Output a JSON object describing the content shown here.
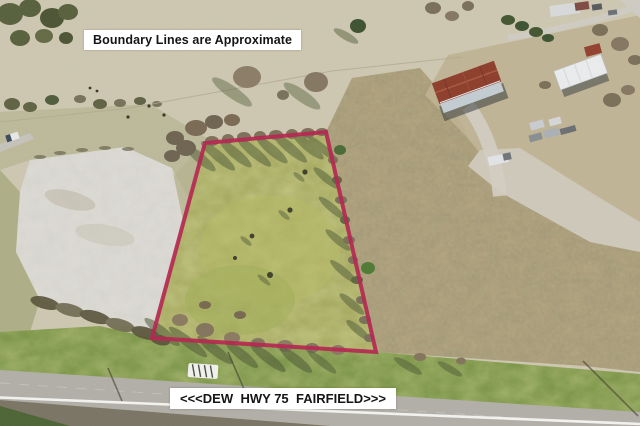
{
  "overlay": {
    "boundary_note": "Boundary Lines are Approximate",
    "road_left": "<<<DEW",
    "road_center": "HWY 75",
    "road_right": "FAIRFIELD>>>"
  },
  "colors": {
    "boundary": "#b5244f",
    "label_bg": "#ffffff",
    "label_text": "#151515",
    "parcel_green": "#a8ab61",
    "road_gray": "#b2afa8",
    "field_pale": "#cbc4ac",
    "field_brown": "#b0a07c",
    "dirt_light": "#dedcd6",
    "verge_green": "#7d9749",
    "barn_roof_red": "#8e3d2b"
  }
}
